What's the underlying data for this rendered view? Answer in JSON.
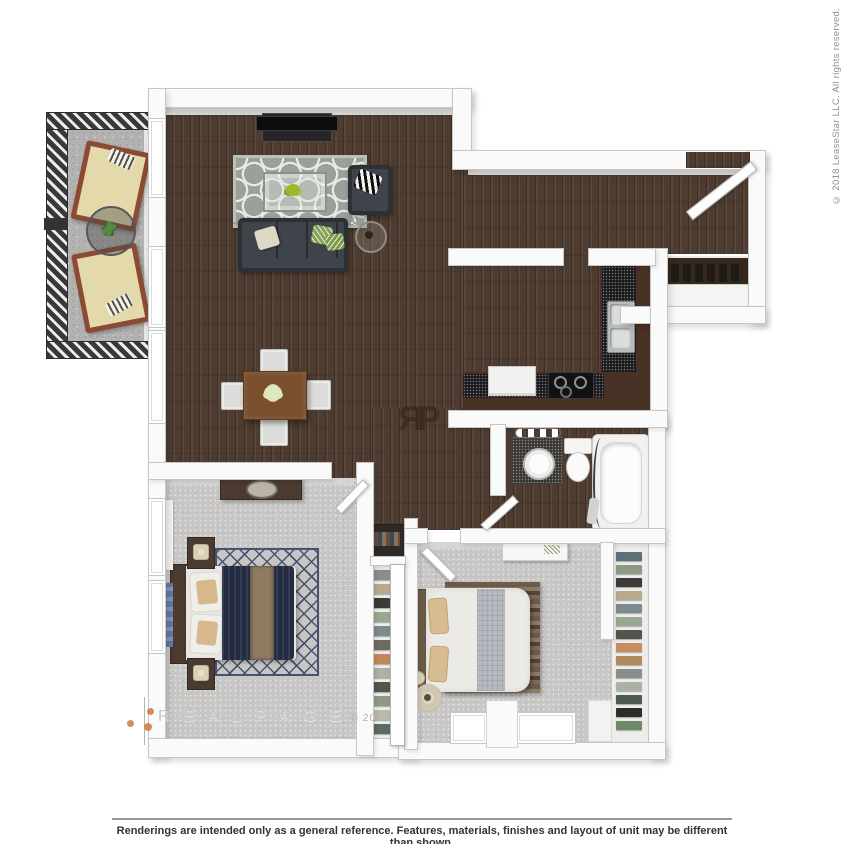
{
  "copyright_vertical": "© 2018 LeaseStar LLC. All rights reserved.",
  "watermarks": {
    "brand": "R E A L P A G E",
    "brand_year": "© 2018",
    "monogram_r": "R",
    "monogram_p": "P"
  },
  "footer": {
    "disclaimer": "Renderings are intended only as a general reference. Features, materials, finishes and layout of unit may be different than shown."
  },
  "palette": {
    "wood_floor": "#4e3c30",
    "carpet": "#c8c7c5",
    "wall": "#fafafa",
    "wall_edge": "#c6c6c6",
    "balcony_floor": "#b3b2b0",
    "railing": "#39393b",
    "cabinet": "#4a3126",
    "granite": "#1a1a1d",
    "sofa": "#3f434a",
    "bed_navy": "#242c44",
    "throw_tan": "#8d7b62",
    "rug_living": "#9aa19b",
    "rug_navy_line": "#46536e",
    "accent_orange": "#cf7f4e",
    "watermark_gray": "#c6c6c6",
    "footer_text": "#333333"
  }
}
